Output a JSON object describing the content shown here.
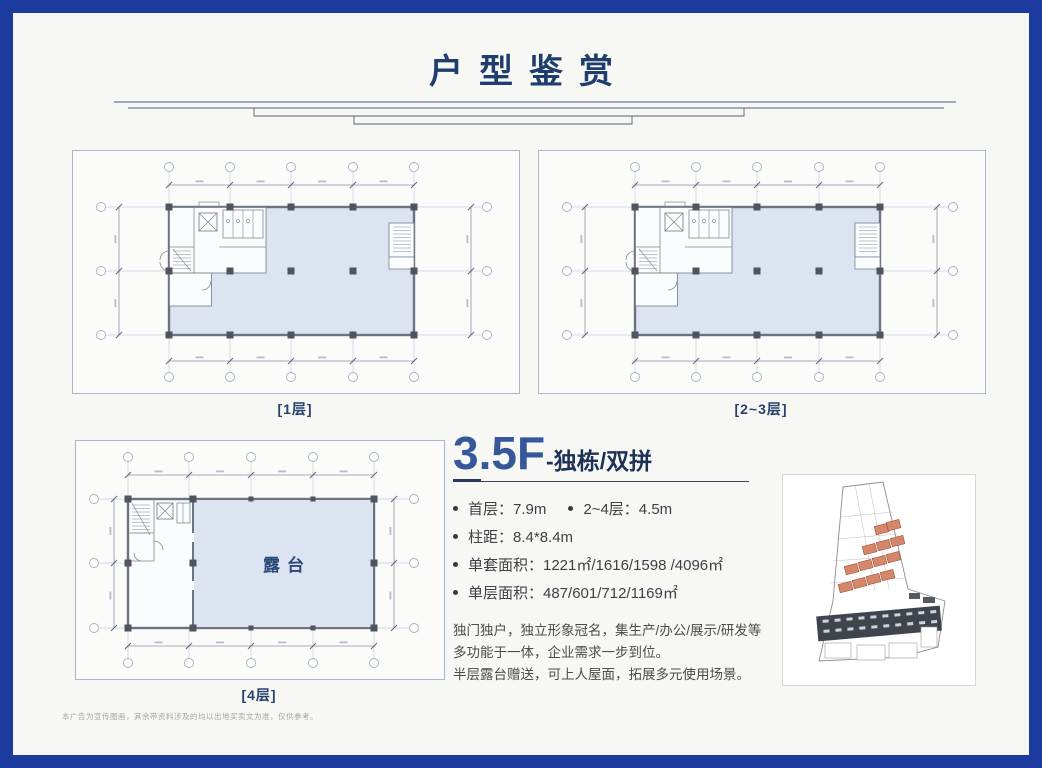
{
  "page": {
    "title": "户型鉴赏",
    "disclaimer": "本广告为宣传图画，其余带资料涉及的均以出地买卖文为准，仅供参考。"
  },
  "plans": [
    {
      "label": "[1层]"
    },
    {
      "label": "[2~3层]"
    },
    {
      "label": "[4层]",
      "room_label": "露台"
    }
  ],
  "spec": {
    "headline": "3.5F",
    "headline_suffix": "-独栋/双拼",
    "rows": {
      "r1a": "首层：7.9m",
      "r1b": "2~4层：4.5m",
      "r2": "柱距：8.4*8.4m",
      "r3": "单套面积：1221㎡/1616/1598 /4096㎡",
      "r4": "单层面积：487/601/712/1169㎡"
    },
    "description": [
      "独门独户，独立形象冠名，集生产/办公/展示/研发等",
      "多功能于一体，企业需求一步到位。",
      "半层露台赠送，可上人屋面，拓展多元使用场景。"
    ]
  },
  "colors": {
    "frame_blue": "#1a3a9e",
    "page_bg": "#f7f7f4",
    "title_navy": "#1f3e6d",
    "accent_blue": "#36589a",
    "dark_navy": "#1d3156",
    "plan_fill": "#dce3f1",
    "text_gray": "#4c4c4c",
    "label_navy": "#27406c",
    "site_orange": "#d4876b"
  }
}
